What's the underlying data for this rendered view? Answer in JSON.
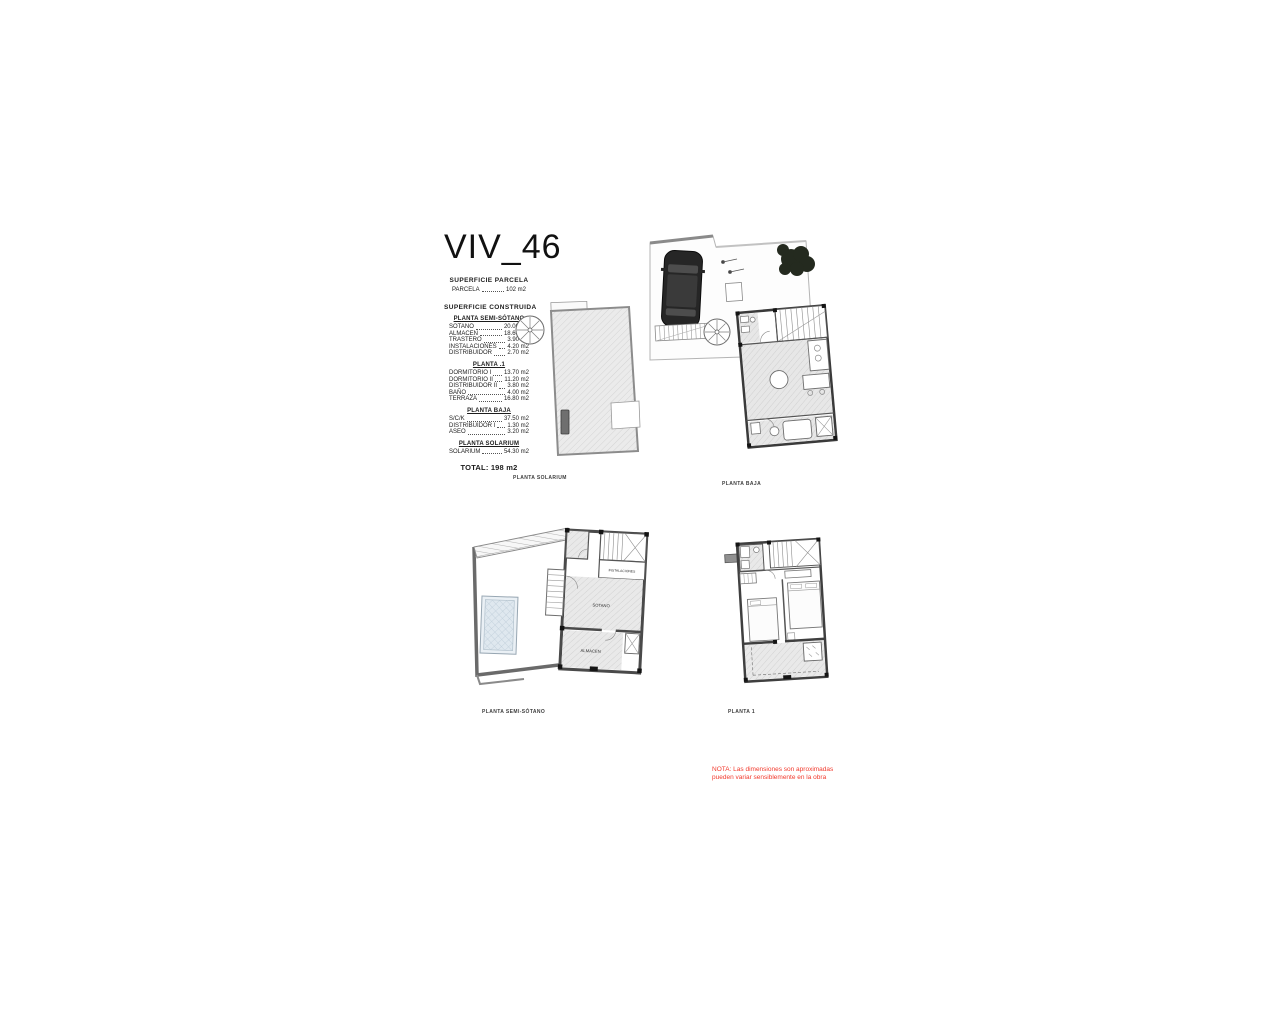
{
  "title": "VIV_46",
  "parcel": {
    "heading": "SUPERFICIE PARCELA",
    "row": {
      "label": "PARCELA",
      "value": "102 m2"
    }
  },
  "built": {
    "heading": "SUPERFICIE CONSTRUIDA",
    "sections": [
      {
        "heading": "PLANTA SEMI-SÓTANO",
        "rows": [
          {
            "label": "SOTANO",
            "value": "20.00 m2"
          },
          {
            "label": "ALMACEN",
            "value": "18.60 m2"
          },
          {
            "label": "TRASTERO",
            "value": "3.90 m2"
          },
          {
            "label": "INSTALACIONES",
            "value": "4.20 m2"
          },
          {
            "label": "DISTRIBUIDOR",
            "value": "2.70 m2"
          }
        ]
      },
      {
        "heading": "PLANTA .1",
        "rows": [
          {
            "label": "DORMITORIO I",
            "value": "13.70 m2"
          },
          {
            "label": "DORMITORIO II",
            "value": "11.20 m2"
          },
          {
            "label": "DISTRIBUIDOR II",
            "value": "3.80 m2"
          },
          {
            "label": "BAÑO",
            "value": "4.00 m2"
          },
          {
            "label": "TERRAZA",
            "value": "16.80 m2"
          }
        ]
      },
      {
        "heading": "PLANTA BAJA",
        "rows": [
          {
            "label": "S/C/K",
            "value": "37.50 m2"
          },
          {
            "label": "DISTRIBUIDOR I",
            "value": "1.30 m2"
          },
          {
            "label": "ASEO",
            "value": "3.20 m2"
          }
        ]
      },
      {
        "heading": "PLANTA SOLARIUM",
        "rows": [
          {
            "label": "SOLARIUM",
            "value": "54.30 m2"
          }
        ]
      }
    ],
    "total": "TOTAL: 198 m2"
  },
  "plans": {
    "solarium": {
      "caption": "PLANTA SOLARIUM"
    },
    "baja": {
      "caption": "PLANTA BAJA"
    },
    "semisotano": {
      "caption": "PLANTA SEMI-SÓTANO",
      "rooms": {
        "instalaciones": "INSTALACIONES",
        "sotano": "SOTANO",
        "almacen": "ALMACEN"
      }
    },
    "planta1": {
      "caption": "PLANTA 1"
    }
  },
  "note": {
    "line1": "NOTA: Las dimensiones son aproximadas",
    "line2": "pueden variar sensiblemente en la obra",
    "color": "#f2392c"
  }
}
